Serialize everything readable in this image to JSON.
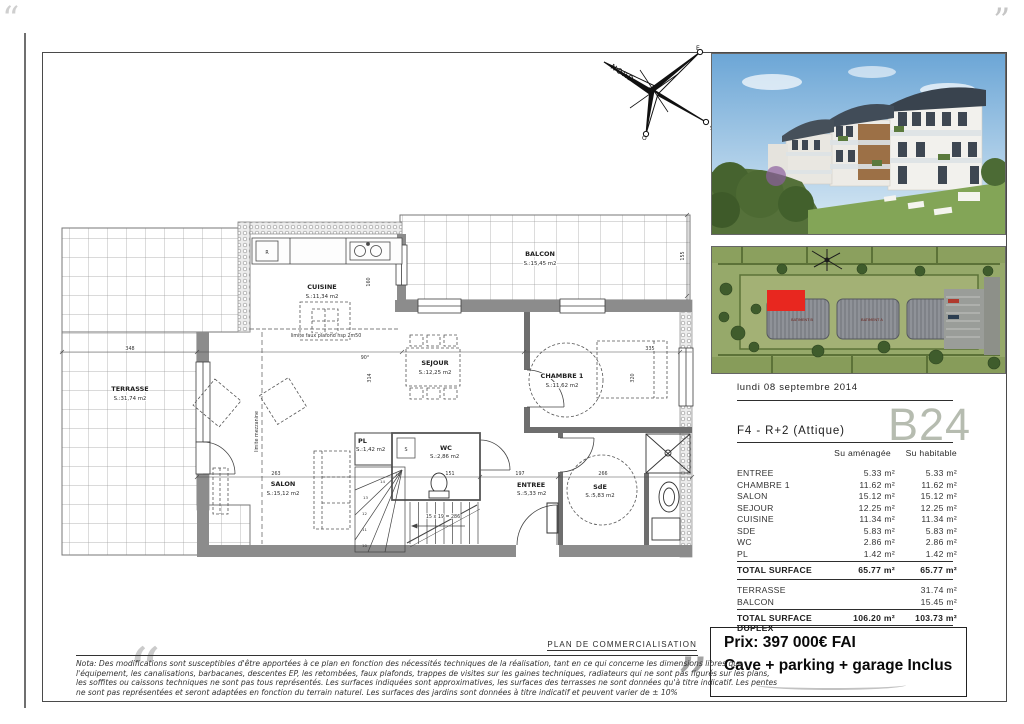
{
  "document": {
    "plan_label": "PLAN DE COMMERCIALISATION",
    "note_lines": [
      "Nota: Des modifications sont susceptibles d'être apportées à ce plan en fonction des nécessités techniques de la réalisation, tant en ce qui concerne les dimensions libres que",
      "l'équipement, les canalisations, barbacanes, descentes EP, les retombées, faux plafonds, trappes de visites sur les gaines techniques, radiateurs qui ne sont pas figurés sur les plans,",
      "les soffites ou caissons techniques ne sont pas tous représentés. Les surfaces indiquées sont approximatives, les surfaces des terrasses ne sont données qu'à titre indicatif. Les pentes",
      "ne sont pas représentées et seront adaptées en fonction du terrain naturel. Les surfaces des jardins sont données à titre indicatif et peuvent varier de ± 10%"
    ],
    "artifacts": {
      "quote_open": "“",
      "quote_close": "”"
    }
  },
  "compass": {
    "nord": "NORD",
    "est": "E",
    "sud": "S",
    "ouest": "O"
  },
  "floorplan": {
    "terrasse": {
      "name": "TERRASSE",
      "surface": "S.:31,74 m2"
    },
    "balcon": {
      "name": "BALCON",
      "surface": "S.:15,45 m2"
    },
    "cuisine": {
      "name": "CUISINE",
      "surface": "S.:11,34 m2"
    },
    "sejour": {
      "name": "SEJOUR",
      "surface": "S.:12,25 m2"
    },
    "chambre1": {
      "name": "CHAMBRE 1",
      "surface": "S.:11,62 m2"
    },
    "salon": {
      "name": "SALON",
      "surface": "S.:15,12 m2"
    },
    "wc": {
      "name": "WC",
      "surface": "S.:2,86 m2"
    },
    "pl": {
      "name": "PL",
      "surface": "S.:1,42 m2"
    },
    "entree": {
      "name": "ENTREE",
      "surface": "S.:5,33 m2"
    },
    "sde": {
      "name": "SdE",
      "surface": "S.:5,83 m2"
    },
    "annotations": {
      "faux_plafond": "limite faux plafond hsp 2m50",
      "mezzanine": "limite mezzanine",
      "stairs": "15 x 19 = 286",
      "angle": "90°",
      "fridge": "R",
      "sink": "S"
    },
    "dims": {
      "d348": "348",
      "d263": "263",
      "d151": "151",
      "d197": "197",
      "d266": "266",
      "d314": "314",
      "d160": "160",
      "d155": "155",
      "d320": "320",
      "d335": "335",
      "s10": "10",
      "s11": "11",
      "s12": "12",
      "s13": "13",
      "s14": "14",
      "s15": "15"
    }
  },
  "siteplan": {
    "batiment_b": "BATIMENT B",
    "batiment_a": "BATIMENT A"
  },
  "panel": {
    "date": "lundi 08 septembre 2014",
    "unit_code": "B24",
    "unit_type": "F4 - R+2 (Attique)",
    "columns": {
      "amenagee": "Su aménagée",
      "habitable": "Su habitable"
    },
    "rows": [
      {
        "label": "ENTREE",
        "amenagee": "5.33 m²",
        "habitable": "5.33 m²"
      },
      {
        "label": "CHAMBRE 1",
        "amenagee": "11.62 m²",
        "habitable": "11.62 m²"
      },
      {
        "label": "SALON",
        "amenagee": "15.12 m²",
        "habitable": "15.12 m²"
      },
      {
        "label": "SEJOUR",
        "amenagee": "12.25 m²",
        "habitable": "12.25 m²"
      },
      {
        "label": "CUISINE",
        "amenagee": "11.34 m²",
        "habitable": "11.34 m²"
      },
      {
        "label": "SDE",
        "amenagee": "5.83 m²",
        "habitable": "5.83 m²"
      },
      {
        "label": "WC",
        "amenagee": "2.86 m²",
        "habitable": "2.86 m²"
      },
      {
        "label": "PL",
        "amenagee": "1.42 m²",
        "habitable": "1.42 m²"
      }
    ],
    "total": {
      "label": "TOTAL SURFACE",
      "amenagee": "65.77 m²",
      "habitable": "65.77 m²"
    },
    "annex_rows": [
      {
        "label": "TERRASSE",
        "habitable": "31.74 m²"
      },
      {
        "label": "BALCON",
        "habitable": "15.45 m²"
      }
    ],
    "duplex": {
      "label": "TOTAL SURFACE DUPLEX",
      "amenagee": "106.20 m²",
      "habitable": "103.73 m²"
    },
    "price": "Prix: 397 000€ FAI",
    "price_note": "Cave + parking + garage Inclus",
    "accent_color": "#b6bcb0"
  }
}
